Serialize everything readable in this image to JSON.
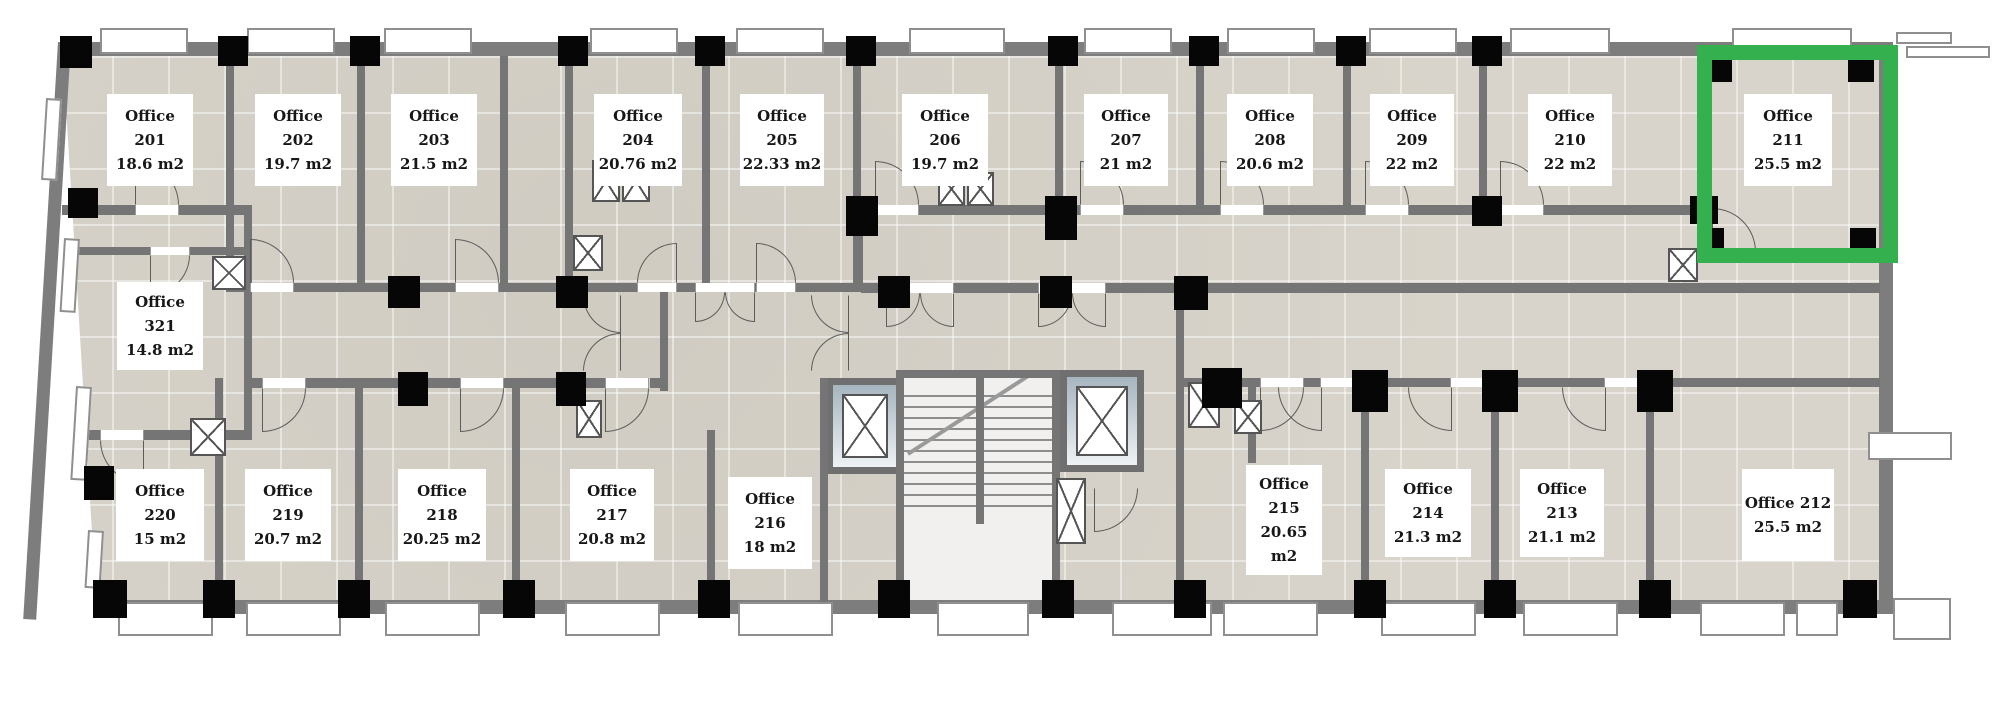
{
  "meta": {
    "plan_type": "office floor plan",
    "highlight_color": "#35b04e",
    "highlighted_room": "Office 211",
    "area_unit": "m2"
  },
  "rooms": [
    {
      "id": "office-201",
      "name": "Office 201",
      "area": "18.6 m2",
      "cx": 150,
      "cy": 140,
      "w": 86,
      "h": 92,
      "highlighted": false
    },
    {
      "id": "office-202",
      "name": "Office 202",
      "area": "19.7 m2",
      "cx": 298,
      "cy": 140,
      "w": 86,
      "h": 92,
      "highlighted": false
    },
    {
      "id": "office-203",
      "name": "Office 203",
      "area": "21.5 m2",
      "cx": 434,
      "cy": 140,
      "w": 86,
      "h": 92,
      "highlighted": false
    },
    {
      "id": "office-204",
      "name": "Office 204",
      "area": "20.76 m2",
      "cx": 638,
      "cy": 140,
      "w": 88,
      "h": 92,
      "highlighted": false
    },
    {
      "id": "office-205",
      "name": "Office 205",
      "area": "22.33 m2",
      "cx": 782,
      "cy": 140,
      "w": 84,
      "h": 92,
      "highlighted": false
    },
    {
      "id": "office-206",
      "name": "Office 206",
      "area": "19.7 m2",
      "cx": 945,
      "cy": 140,
      "w": 86,
      "h": 92,
      "highlighted": false
    },
    {
      "id": "office-207",
      "name": "Office 207",
      "area": "21 m2",
      "cx": 1126,
      "cy": 140,
      "w": 84,
      "h": 92,
      "highlighted": false
    },
    {
      "id": "office-208",
      "name": "Office 208",
      "area": "20.6 m2",
      "cx": 1270,
      "cy": 140,
      "w": 86,
      "h": 92,
      "highlighted": false
    },
    {
      "id": "office-209",
      "name": "Office 209",
      "area": "22 m2",
      "cx": 1412,
      "cy": 140,
      "w": 84,
      "h": 92,
      "highlighted": false
    },
    {
      "id": "office-210",
      "name": "Office 210",
      "area": "22 m2",
      "cx": 1570,
      "cy": 140,
      "w": 84,
      "h": 92,
      "highlighted": false
    },
    {
      "id": "office-211",
      "name": "Office 211",
      "area": "25.5 m2",
      "cx": 1788,
      "cy": 140,
      "w": 88,
      "h": 92,
      "highlighted": true
    },
    {
      "id": "office-321",
      "name": "Office 321",
      "area": "14.8 m2",
      "cx": 160,
      "cy": 326,
      "w": 86,
      "h": 88,
      "highlighted": false
    },
    {
      "id": "office-220",
      "name": "Office 220",
      "area": "15 m2",
      "cx": 160,
      "cy": 515,
      "w": 88,
      "h": 92,
      "highlighted": false
    },
    {
      "id": "office-219",
      "name": "Office 219",
      "area": "20.7 m2",
      "cx": 288,
      "cy": 515,
      "w": 86,
      "h": 92,
      "highlighted": false
    },
    {
      "id": "office-218",
      "name": "Office 218",
      "area": "20.25 m2",
      "cx": 442,
      "cy": 515,
      "w": 88,
      "h": 92,
      "highlighted": false
    },
    {
      "id": "office-217",
      "name": "Office 217",
      "area": "20.8 m2",
      "cx": 612,
      "cy": 515,
      "w": 84,
      "h": 92,
      "highlighted": false
    },
    {
      "id": "office-216",
      "name": "Office 216",
      "area": "18 m2",
      "cx": 770,
      "cy": 523,
      "w": 84,
      "h": 92,
      "highlighted": false
    },
    {
      "id": "office-215",
      "name": "Office 215",
      "area": "20.65 m2",
      "cx": 1284,
      "cy": 520,
      "w": 76,
      "h": 110,
      "highlighted": false
    },
    {
      "id": "office-214",
      "name": "Office 214",
      "area": "21.3 m2",
      "cx": 1428,
      "cy": 513,
      "w": 86,
      "h": 88,
      "highlighted": false
    },
    {
      "id": "office-213",
      "name": "Office 213",
      "area": "21.1 m2",
      "cx": 1562,
      "cy": 513,
      "w": 84,
      "h": 88,
      "highlighted": false
    },
    {
      "id": "office-212",
      "name": "Office 212",
      "area": "25.5 m2",
      "cx": 1788,
      "cy": 515,
      "w": 92,
      "h": 92,
      "highlighted": false
    }
  ]
}
